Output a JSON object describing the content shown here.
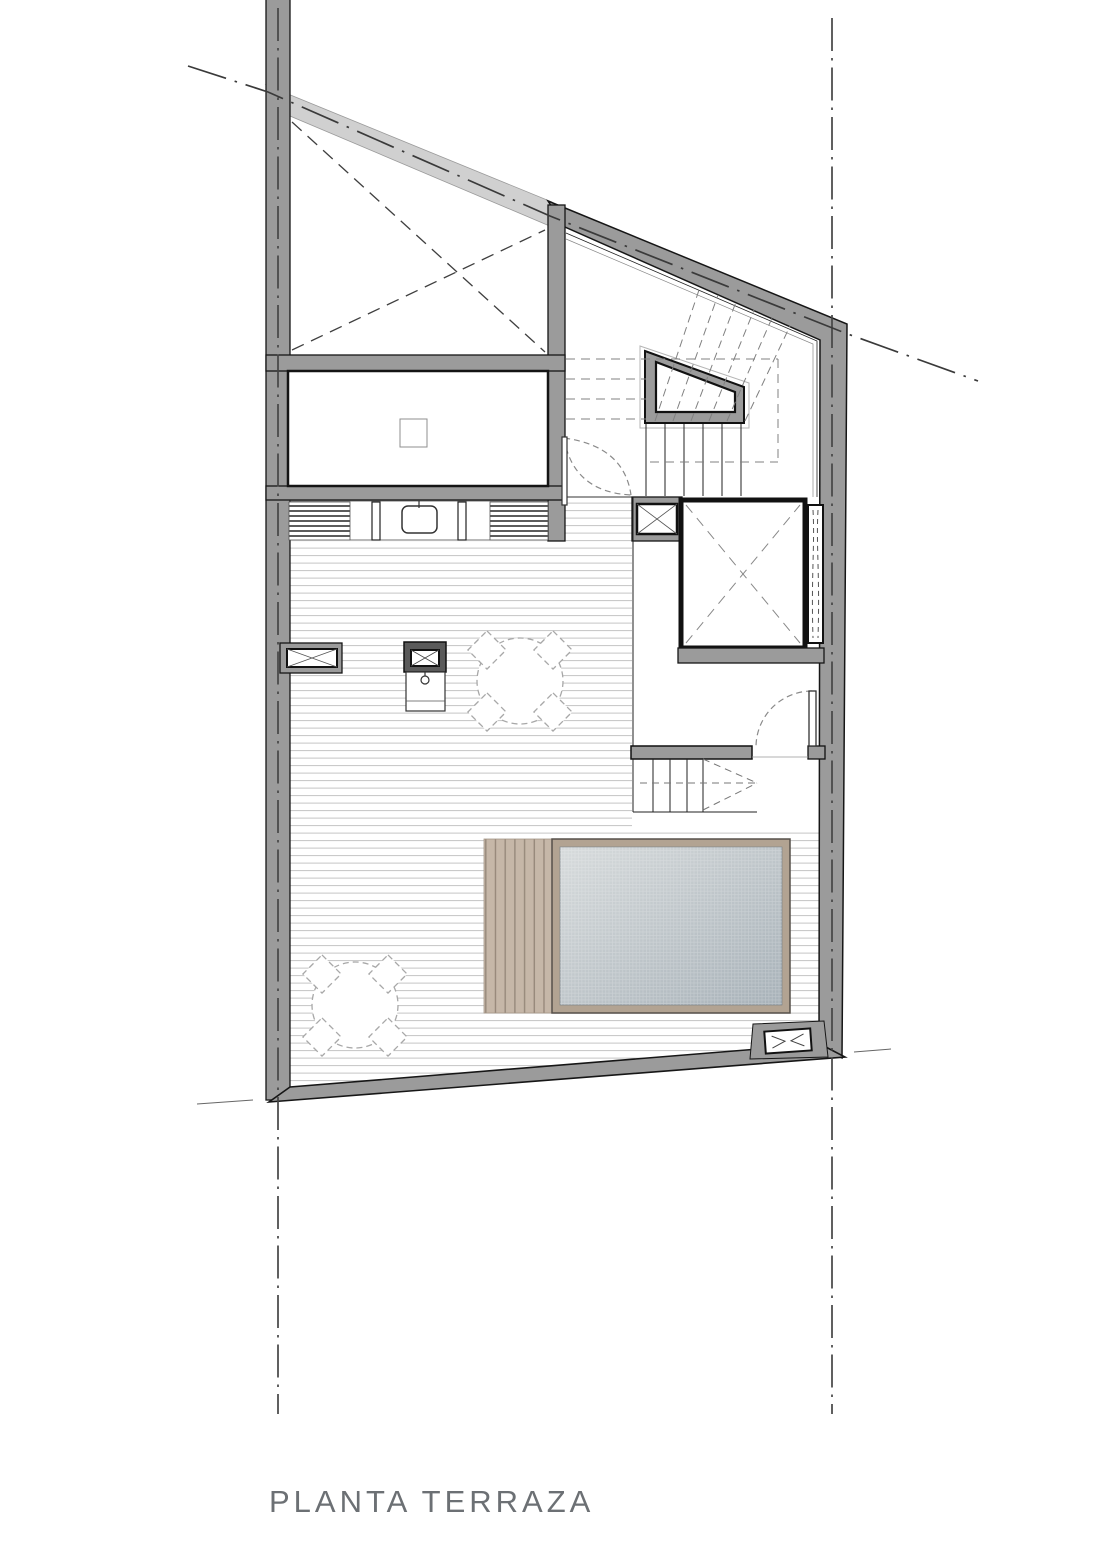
{
  "title": {
    "label": "PLANTA TERRAZA"
  },
  "colors": {
    "background": "#ffffff",
    "wall_dark": "#9b9b9b",
    "wall_light": "#d0d0d0",
    "wall_outline": "#161616",
    "deck_line": "#c4c4c4",
    "boundary_line": "#454545",
    "dashed_detail": "#808080",
    "wood_deck": "#c6b7a8",
    "wood_deck_line": "#97897b",
    "pool_frame": "#b2a392",
    "water_light": "#d7dbdc",
    "water_dark": "#a7b1b8",
    "title_text": "#6c7074"
  }
}
